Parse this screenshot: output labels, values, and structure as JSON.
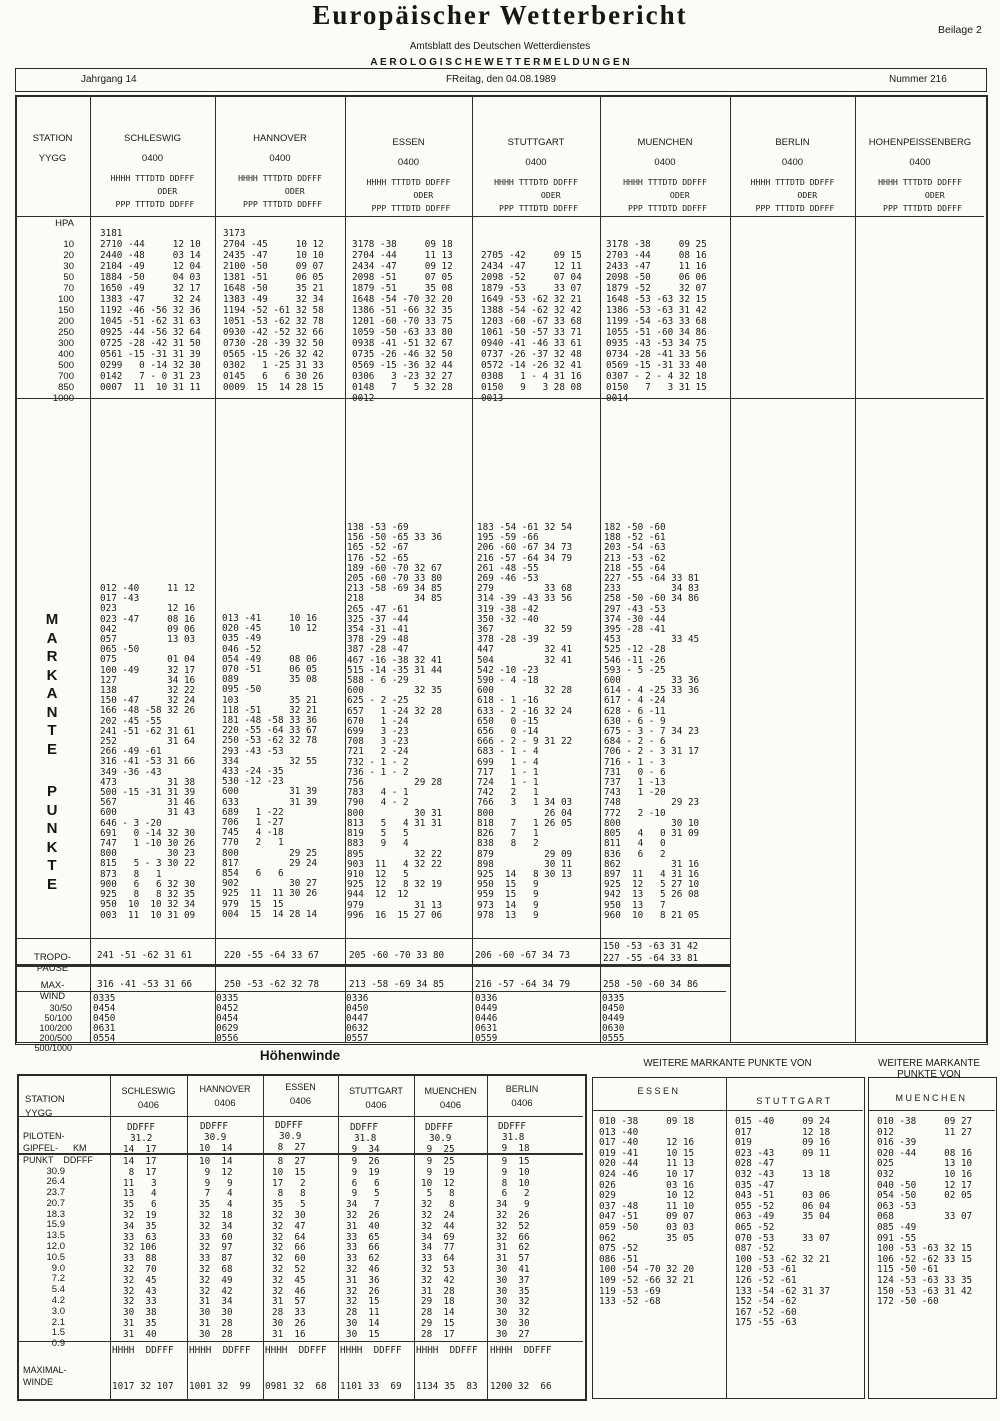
{
  "header": {
    "title": "Europäischer Wetterbericht",
    "subtitle": "Amtsblatt des Deutschen Wetterdienstes",
    "section": "A E R O L O G I S C H E   W E T T E R M E L D U N G E N",
    "beilage": "Beilage 2"
  },
  "band": {
    "jahrgang": "Jahrgang 14",
    "date": "FReitag, den 04.08.1989",
    "nummer": "Nummer 216"
  },
  "main": {
    "station_label": "STATION",
    "yygg_label": "YYGG",
    "obs_header": [
      "HHHH TTTDTD DDFFF",
      "      ODER",
      " PPP TTTDTD DDFFF"
    ],
    "stations": [
      {
        "name": "SCHLESWIG",
        "time": "0400"
      },
      {
        "name": "HANNOVER",
        "time": "0400"
      },
      {
        "name": "ESSEN",
        "time": "0400"
      },
      {
        "name": "STUTTGART",
        "time": "0400"
      },
      {
        "name": "MUENCHEN",
        "time": "0400"
      },
      {
        "name": "BERLIN",
        "time": "0400"
      },
      {
        "name": "HOHENPEISSENBERG",
        "time": "0400"
      }
    ],
    "hpa": {
      "unit": "HPA",
      "levels": [
        "10",
        "20",
        "30",
        "50",
        "70",
        "100",
        "150",
        "200",
        "250",
        "300",
        "400",
        "500",
        "700",
        "850",
        "1000"
      ],
      "schleswig": [
        "3181",
        "2710 -44     12 10",
        "2440 -48     03 14",
        "2104 -49     12 04",
        "1884 -50     04 03",
        "1650 -49     32 17",
        "1383 -47     32 24",
        "1192 -46 -56 32 36",
        "1045 -51 -62 31 63",
        "0925 -44 -56 32 64",
        "0725 -28 -42 31 50",
        "0561 -15 -31 31 39",
        "0299   0 -14 32 30",
        "0142   7 - 0 31 23",
        "0007  11  10 31 11"
      ],
      "hannover": [
        "3173",
        "2704 -45     10 12",
        "2435 -47     10 10",
        "2100 -50     09 07",
        "1381 -51     06 05",
        "1648 -50     35 21",
        "1383 -49     32 34",
        "1194 -52 -61 32 58",
        "1051 -53 -62 32 78",
        "0930 -42 -52 32 66",
        "0730 -28 -39 32 50",
        "0565 -15 -26 32 42",
        "0302   1 -25 31 33",
        "0145   6   6 30 26",
        "0009  15  14 28 15"
      ],
      "essen": [
        "3178 -38     09 18",
        "2704 -44     11 13",
        "2434 -47     09 12",
        "2098 -51     07 05",
        "1879 -51     35 08",
        "1648 -54 -70 32 20",
        "1386 -51 -66 32 35",
        "1201 -60 -70 33 75",
        "1059 -50 -63 33 80",
        "0938 -41 -51 32 67",
        "0735 -26 -46 32 50",
        "0569 -15 -36 32 44",
        "0306   3 -23 32 27",
        "0148   7   5 32 28",
        "0012"
      ],
      "stuttgart": [
        "2705 -42     09 15",
        "2434 -47     12 11",
        "2098 -52     07 04",
        "1879 -53     33 07",
        "1649 -53 -62 32 21",
        "1388 -54 -62 32 42",
        "1203 -60 -67 33 68",
        "1061 -50 -57 33 71",
        "0940 -41 -46 33 61",
        "0737 -26 -37 32 48",
        "0572 -14 -26 32 41",
        "0308   1 - 4 31 16",
        "0150   9   3 28 08",
        "0013"
      ],
      "muenchen": [
        "3178 -38     09 25",
        "2703 -44     08 16",
        "2433 -47     11 16",
        "2098 -50     06 06",
        "1879 -52     32 07",
        "1648 -53 -63 32 15",
        "1386 -53 -63 31 42",
        "1199 -54 -63 33 68",
        "1055 -51 -60 34 86",
        "0935 -43 -53 34 75",
        "0734 -28 -41 33 56",
        "0569 -15 -31 33 40",
        "0307 - 2 - 4 32 18",
        "0150   7   3 31 15",
        "0014"
      ]
    },
    "markante": {
      "word1": [
        "M",
        "A",
        "R",
        "K",
        "A",
        "N",
        "T",
        "E"
      ],
      "word2": [
        "P",
        "U",
        "N",
        "K",
        "T",
        "E"
      ],
      "schleswig": [
        "012 -40     11 12",
        "017 -43",
        "023         12 16",
        "023 -47     08 16",
        "042         09 06",
        "057         13 03",
        "065 -50",
        "075         01 04",
        "100 -49     32 17",
        "127         34 16",
        "138         32 22",
        "150 -47     32 24",
        "166 -48 -58 32 26",
        "202 -45 -55",
        "241 -51 -62 31 61",
        "252         31 64",
        "266 -49 -61",
        "316 -41 -53 31 66",
        "349 -36 -43",
        "473         31 38",
        "500 -15 -31 31 39",
        "567         31 46",
        "600         31 43",
        "646 - 3 -20",
        "691   0 -14 32 30",
        "747   1 -10 30 26",
        "800         30 23",
        "815   5 - 3 30 22",
        "873   8   1",
        "900   6   6 32 30",
        "925   8   8 32 35",
        "950  10  10 32 34",
        "003  11  10 31 09"
      ],
      "hannover": [
        "013 -41     10 16",
        "020 -45     10 12",
        "035 -49",
        "046 -52",
        "054 -49     08 06",
        "070 -51     06 05",
        "089         35 08",
        "095 -50",
        "103         35 21",
        "118 -51     32 21",
        "181 -48 -58 33 36",
        "220 -55 -64 33 67",
        "250 -53 -62 32 78",
        "293 -43 -53",
        "334         32 55",
        "433 -24 -35",
        "530 -12 -23",
        "600         31 39",
        "633         31 39",
        "689   1 -22",
        "706   1 -27",
        "745   4 -18",
        "770   2   1",
        "800         29 25",
        "817         29 24",
        "854   6   6",
        "902         30 27",
        "925  11  11 30 26",
        "979  15  15",
        "004  15  14 28 14"
      ],
      "essen": [
        "138 -53 -69",
        "156 -50 -65 33 36",
        "165 -52 -67",
        "176 -52 -65",
        "189 -60 -70 32 67",
        "205 -60 -70 33 80",
        "213 -58 -69 34 85",
        "218         34 85",
        "265 -47 -61",
        "325 -37 -44",
        "354 -31 -41",
        "378 -29 -48",
        "387 -28 -47",
        "467 -16 -38 32 41",
        "515 -14 -35 31 44",
        "588 - 6 -29",
        "600         32 35",
        "625 - 2 -25",
        "657   1 -24 32 28",
        "670   1 -24",
        "699   3 -23",
        "708   3 -23",
        "721   2 -24",
        "732 - 1 - 2",
        "736 - 1 - 2",
        "756         29 28",
        "783   4 - 1",
        "790   4 - 2",
        "800         30 31",
        "813   5   4 31 31",
        "819   5   5",
        "883   9   4",
        "895         32 22",
        "903  11   4 32 22",
        "910  12   5",
        "925  12   8 32 19",
        "944  12  12",
        "979         31 13",
        "996  16  15 27 06"
      ],
      "stuttgart": [
        "183 -54 -61 32 54",
        "195 -59 -66",
        "206 -60 -67 34 73",
        "216 -57 -64 34 79",
        "261 -48 -55",
        "269 -46 -53",
        "279         33 68",
        "314 -39 -43 33 56",
        "319 -38 -42",
        "350 -32 -40",
        "367         32 59",
        "378 -28 -39",
        "447         32 41",
        "504         32 41",
        "542 -10 -23",
        "590 - 4 -18",
        "600         32 28",
        "618 - 1 -16",
        "633 - 2 -16 32 24",
        "650   0 -15",
        "656   0 -14",
        "666 - 2 - 9 31 22",
        "683 - 1 - 4",
        "699   1 - 4",
        "717   1 - 1",
        "724   1 - 1",
        "742   2   1",
        "766   3   1 34 03",
        "800         26 04",
        "818   7   1 26 05",
        "826   7   1",
        "838   8   2",
        "879         29 09",
        "898         30 11",
        "925  14   8 30 13",
        "950  15   9",
        "959  15   9",
        "973  14   9",
        "978  13   9"
      ],
      "muenchen": [
        "182 -50 -60",
        "188 -52 -61",
        "203 -54 -63",
        "213 -53 -62",
        "218 -55 -64",
        "227 -55 -64 33 81",
        "233         34 83",
        "258 -50 -60 34 86",
        "297 -43 -53",
        "374 -30 -44",
        "395 -28 -41",
        "453         33 45",
        "525 -12 -28",
        "546 -11 -26",
        "593 - 5 -25",
        "600         33 36",
        "614 - 4 -25 33 36",
        "617 - 4 -24",
        "628 - 6 -11",
        "630 - 6 - 9",
        "675 - 3 - 7 34 23",
        "684 - 2 - 6",
        "706 - 2 - 3 31 17",
        "716 - 1 - 3",
        "731   0 - 6",
        "737   1 -13",
        "743   1 -20",
        "748         29 23",
        "772   2 -10",
        "800         30 10",
        "805   4   0 31 09",
        "811   4   0",
        "836   6   2",
        "862         31 16",
        "897  11   4 31 16",
        "925  12   5 27 10",
        "942  13   5 26 08",
        "950  13   7",
        "960  10   8 21 05"
      ]
    },
    "tropo": {
      "label": [
        "TROPO-",
        "PAUSE"
      ],
      "schleswig": "241 -51 -62 31 61",
      "hannover": "220 -55 -64 33 67",
      "essen": "205 -60 -70 33 80",
      "stuttgart": "206 -60 -67 34 73",
      "muenchen": [
        "150 -53 -63 31 42",
        "227 -55 -64 33 81"
      ]
    },
    "maxwind": {
      "label": [
        "MAX-",
        "WIND"
      ],
      "schleswig": "316 -41 -53 31 66",
      "hannover": "250 -53 -62 32 78",
      "essen": "213 -58 -69 34 85",
      "stuttgart": "216 -57 -64 34 79",
      "muenchen": "258 -50 -60 34 86"
    },
    "layers": {
      "labels": [
        "30/50",
        "50/100",
        "100/200",
        "200/500",
        "500/1000"
      ],
      "schleswig": [
        "0335",
        "0454",
        "0450",
        "0631",
        "0554"
      ],
      "hannover": [
        "0335",
        "0452",
        "0454",
        "0629",
        "0556"
      ],
      "essen": [
        "0336",
        "0450",
        "0447",
        "0632",
        "0557"
      ],
      "stuttgart": [
        "0336",
        "0449",
        "0446",
        "0631",
        "0559"
      ],
      "muenchen": [
        "0335",
        "0450",
        "0449",
        "0630",
        "0555"
      ]
    }
  },
  "hoehenwinde": {
    "title": "Höhenwinde",
    "station_label": [
      "STATION",
      "YYGG"
    ],
    "piloten_label": [
      "PILOTEN-",
      "GIPFEL-      KM",
      "PUNKT    DDFFF"
    ],
    "ddfff": "DDFFF",
    "stations": [
      {
        "name": "SCHLESWIG",
        "time": "0406",
        "gipfel": "31.2",
        "wind": "14  17"
      },
      {
        "name": "HANNOVER",
        "time": "0406",
        "gipfel": "30.9",
        "wind": "10  14"
      },
      {
        "name": "ESSEN",
        "time": "0406",
        "gipfel": "30.9",
        "wind": " 8  27"
      },
      {
        "name": "STUTTGART",
        "time": "0406",
        "gipfel": "31.8",
        "wind": " 9  34"
      },
      {
        "name": "MUENCHEN",
        "time": "0406",
        "gipfel": "30.9",
        "wind": " 9  25"
      },
      {
        "name": "BERLIN",
        "time": "0406",
        "gipfel": "31.8",
        "wind": " 9  18"
      }
    ],
    "km": [
      "30.9",
      "26.4",
      "23.7",
      "20.7",
      "18.3",
      "15.9",
      "13.5",
      "12.0",
      "10.5",
      "9.0",
      "7.2",
      "5.4",
      "4.2",
      "3.0",
      "2.1",
      "1.5",
      "0.9"
    ],
    "winds": {
      "schleswig": [
        "14  17",
        " 8  17",
        "11   3",
        "13   4",
        "35   6",
        "32  19",
        "34  35",
        "33  63",
        "32 106",
        "33  88",
        "32  70",
        "32  45",
        "32  43",
        "32  33",
        "30  38",
        "31  35",
        "31  40"
      ],
      "hannover": [
        "10  14",
        " 9  12",
        " 9   9",
        " 7   4",
        "35   4",
        "32  18",
        "32  34",
        "33  60",
        "32  97",
        "33  87",
        "32  68",
        "32  49",
        "32  42",
        "31  34",
        "30  30",
        "31  28",
        "30  28"
      ],
      "essen": [
        " 8  27",
        "10  15",
        "17   2",
        " 8   8",
        "35   5",
        "32  30",
        "32  47",
        "32  64",
        "32  66",
        "32  60",
        "32  52",
        "32  45",
        "32  46",
        "31  57",
        "28  33",
        "30  26",
        "31  16"
      ],
      "stuttgart": [
        " 9  26",
        " 9  19",
        " 6   6",
        " 9   5",
        "34   7",
        "32  26",
        "31  40",
        "33  65",
        "33  66",
        "33  62",
        "32  46",
        "31  36",
        "32  26",
        "32  15",
        "28  11",
        "30  14",
        "30  15"
      ],
      "muenchen": [
        " 9  25",
        " 9  19",
        "10  12",
        " 5   8",
        "32   8",
        "32  24",
        "32  44",
        "34  69",
        "34  77",
        "33  64",
        "32  53",
        "32  42",
        "31  28",
        "29  18",
        "28  14",
        "29  15",
        "28  17"
      ],
      "berlin": [
        " 9  15",
        " 9  10",
        " 8  10",
        " 6   2",
        "34   9",
        "32  26",
        "32  52",
        "32  66",
        "31  62",
        "31  57",
        "30  41",
        "30  37",
        "30  35",
        "30  32",
        "30  32",
        "30  30",
        "30  27"
      ]
    },
    "max_label": [
      "MAXIMAL-",
      "WINDE"
    ],
    "max_header": "HHHH  DDFFF",
    "max_values": [
      "1017 32 107",
      "1001 32  99",
      "0981 32  68",
      "1101 33  69",
      "1134 35  83",
      "1200 32  66"
    ]
  },
  "weitere": {
    "header": "WEITERE MARKANTE PUNKTE VON",
    "essen_label": "ESSEN",
    "stuttgart_label": "STUTTGART",
    "muenchen_label": "MUENCHEN",
    "essen": [
      "010 -38     09 18",
      "013 -40",
      "017 -40     12 16",
      "019 -41     10 15",
      "020 -44     11 13",
      "024 -46     10 17",
      "026         03 16",
      "029         10 12",
      "037 -48     11 10",
      "047 -51     09 07",
      "059 -50     03 03",
      "062         35 05",
      "075 -52",
      "086 -51",
      "100 -54 -70 32 20",
      "109 -52 -66 32 21",
      "119 -53 -69",
      "133 -52 -68"
    ],
    "stuttgart": [
      "015 -40     09 24",
      "017         12 18",
      "019         09 16",
      "023 -43     09 11",
      "028 -47",
      "032 -43     13 18",
      "035 -47",
      "043 -51     03 06",
      "055 -52     06 04",
      "063 -49     35 04",
      "065 -52",
      "070 -53     33 07",
      "087 -52",
      "100 -53 -62 32 21",
      "120 -53 -61",
      "126 -52 -61",
      "133 -54 -62 31 37",
      "152 -54 -62",
      "167 -52 -60",
      "175 -55 -63"
    ],
    "muenchen": [
      "010 -38     09 27",
      "012         11 27",
      "016 -39",
      "020 -44     08 16",
      "025         13 10",
      "032         10 16",
      "040 -50     12 17",
      "054 -50     02 05",
      "063 -53",
      "068         33 07",
      "085 -49",
      "091 -55",
      "100 -53 -63 32 15",
      "106 -52 -62 33 15",
      "115 -50 -61",
      "124 -53 -63 33 35",
      "150 -53 -63 31 42",
      "172 -50 -60"
    ]
  }
}
